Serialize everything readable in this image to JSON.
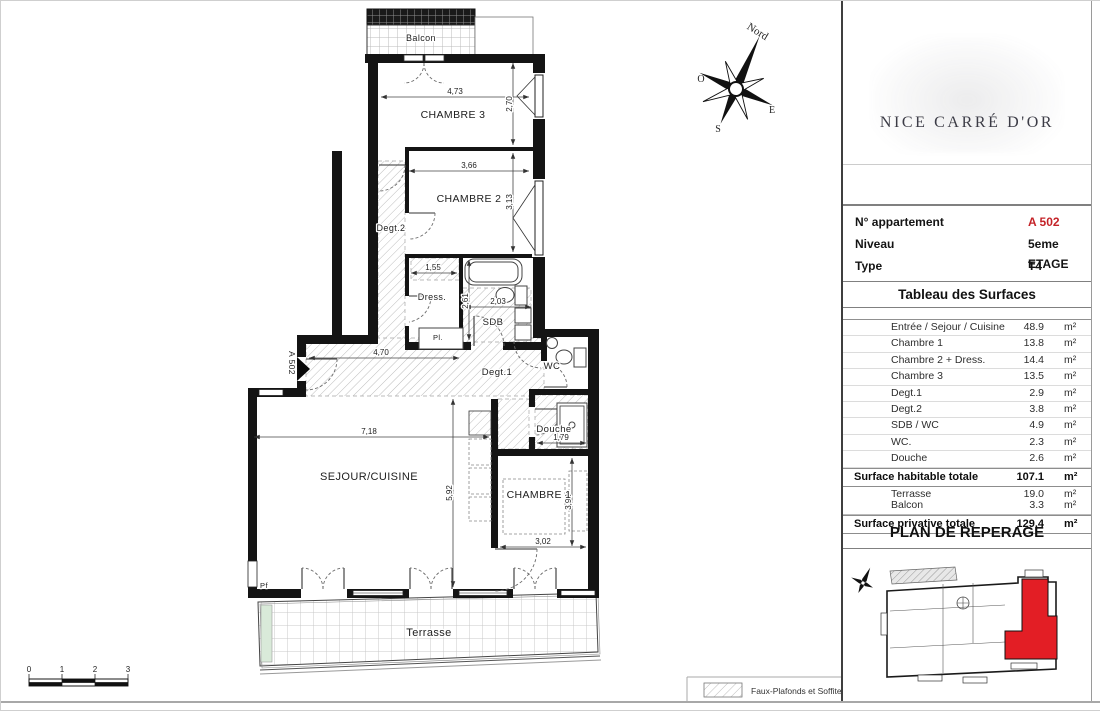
{
  "plan": {
    "tag": "A 502",
    "rooms": {
      "balcon": "Balcon",
      "chambre3": "CHAMBRE 3",
      "chambre2": "CHAMBRE 2",
      "degt2": "Degt.2",
      "dress": "Dress.",
      "sdb": "SDB",
      "wc": "WC",
      "degt1": "Degt.1",
      "pl": "Pl.",
      "sejour": "SEJOUR/CUISINE",
      "chambre1": "CHAMBRE 1",
      "douche": "Douche",
      "terrasse": "Terrasse",
      "pf": "Pf"
    },
    "dims": {
      "d473": "4,73",
      "d270": "2,70",
      "d366": "3,66",
      "d313": "3,13",
      "d155": "1,55",
      "d203": "2,03",
      "d261": "2,61",
      "d470": "4,70",
      "d718": "7,18",
      "d592": "5,92",
      "d179": "1,79",
      "d398": "3,98",
      "d302": "3,02"
    }
  },
  "compass": {
    "north": "Nord",
    "west": "O",
    "east": "E",
    "south": "S"
  },
  "scalebar": {
    "t0": "0",
    "t1": "1",
    "t2": "2",
    "t3": "3"
  },
  "legend": {
    "label": "Faux-Plafonds et Soffites"
  },
  "panel": {
    "title": "NICE CARRÉ D'OR",
    "info": {
      "row1_label": "N° appartement",
      "row1_value": "A 502",
      "row2_label": "Niveau",
      "row2_value": "5eme ETAGE",
      "row3_label": "Type",
      "row3_value": "T4"
    },
    "surfaces_heading": "Tableau des Surfaces",
    "surfaces": [
      {
        "label": "Entrée / Sejour / Cuisine",
        "value": "48.9",
        "unit": "m²"
      },
      {
        "label": "Chambre 1",
        "value": "13.8",
        "unit": "m²"
      },
      {
        "label": "Chambre 2 + Dress.",
        "value": "14.4",
        "unit": "m²"
      },
      {
        "label": "Chambre 3",
        "value": "13.5",
        "unit": "m²"
      },
      {
        "label": "Degt.1",
        "value": "2.9",
        "unit": "m²"
      },
      {
        "label": "Degt.2",
        "value": "3.8",
        "unit": "m²"
      },
      {
        "label": "SDB / WC",
        "value": "4.9",
        "unit": "m²"
      },
      {
        "label": "WC.",
        "value": "2.3",
        "unit": "m²"
      },
      {
        "label": "Douche",
        "value": "2.6",
        "unit": "m²"
      }
    ],
    "habitable": {
      "label": "Surface habitable totale",
      "value": "107.1",
      "unit": "m²"
    },
    "annex": [
      {
        "label": "Terrasse",
        "value": "19.0",
        "unit": "m²"
      },
      {
        "label": "Balcon",
        "value": "3.3",
        "unit": "m²"
      }
    ],
    "privative": {
      "label": "Surface privative totale",
      "value": "129.4",
      "unit": "m²"
    },
    "reperage_heading": "PLAN DE REPERAGE"
  },
  "colors": {
    "accent_red": "#c42328",
    "plan_red": "#e31e25",
    "wall": "#141414"
  }
}
